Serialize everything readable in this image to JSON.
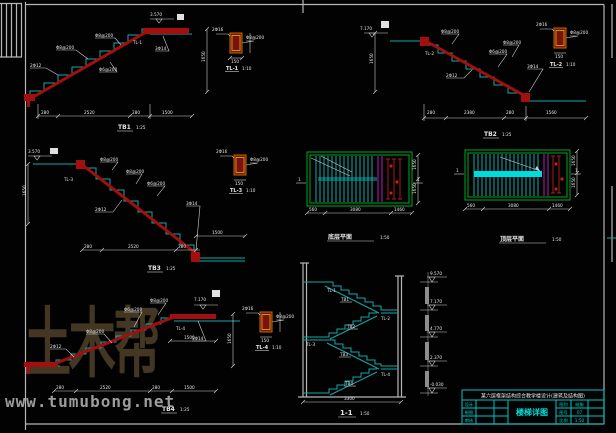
{
  "watermark": {
    "logo": "土木帮",
    "site": "www.tumubong.net"
  },
  "tb1": {
    "title": "TB1",
    "scale": "1:25",
    "level": "3.570",
    "callouts": [
      "Φ8@200",
      "2Φ12",
      "Φ8@200",
      "Φ6@200",
      "3Φ14",
      "TL-1"
    ],
    "dims": {
      "bottom": [
        "280",
        "2520",
        "280",
        "1500"
      ],
      "vertical": "1650"
    },
    "detail": {
      "name": "TL-1",
      "scale": "1:10",
      "width": "150",
      "callouts": [
        "2Φ16",
        "Φ8@200"
      ]
    }
  },
  "tb2": {
    "title": "TB2",
    "scale": "1:25",
    "level": "7.170",
    "callouts": [
      "Φ8@200",
      "Φ6@200",
      "2Φ12",
      "3Φ14",
      "TL-2",
      "Φ8@200"
    ],
    "dims": {
      "bottom": [
        "280",
        "2380",
        "280",
        "1560"
      ],
      "vertical": "1650"
    },
    "detail": {
      "name": "TL-2",
      "scale": "1:10",
      "width": "150",
      "callouts": [
        "2Φ16",
        "Φ8@200"
      ]
    }
  },
  "tb3": {
    "title": "TB3",
    "scale": "1:25",
    "level": "3.570",
    "callouts": [
      "Φ8@200",
      "Φ6@200",
      "2Φ12",
      "3Φ14",
      "TL-3",
      "Φ8@200"
    ],
    "dims": {
      "bottom": [
        "280",
        "2520",
        "280",
        "1500"
      ],
      "vertical": "1650"
    },
    "detail": {
      "name": "TL-3",
      "scale": "1:10",
      "width": "150",
      "callouts": [
        "2Φ16",
        "Φ8@200"
      ]
    }
  },
  "tb4": {
    "title": "TB4",
    "scale": "1:25",
    "level": "7.170",
    "callouts": [
      "2Φ12",
      "Φ8@200",
      "Φ6@200",
      "3Φ14",
      "TL-4",
      "Φ8@200"
    ],
    "dims": {
      "bottom": [
        "280",
        "2520",
        "280",
        "1500"
      ],
      "vertical": "1650"
    },
    "detail": {
      "name": "TL-4",
      "scale": "1:10",
      "width": "150",
      "callouts": [
        "2Φ16",
        "Φ8@200"
      ]
    }
  },
  "plan1": {
    "title": "底层平面",
    "scale": "1:50",
    "mark": "1",
    "dims": [
      "560",
      "3080",
      "1460"
    ],
    "side_dims": [
      "1650",
      "1650"
    ]
  },
  "plan2": {
    "title": "顶层平面",
    "scale": "1:50",
    "mark": "1",
    "dims": [
      "560",
      "3080",
      "1460"
    ],
    "side_dims": [
      "1650",
      "1650"
    ]
  },
  "section": {
    "title": "1-1",
    "scale": "1:50",
    "bottom_dim": "3300",
    "flights": [
      {
        "beam": "TL-1",
        "slab": "TB1"
      },
      {
        "beam": "TL-2",
        "slab": "TB2"
      },
      {
        "beam": "TL-3",
        "slab": "TB3"
      },
      {
        "beam": "TL-4",
        "slab": "TB4"
      }
    ],
    "levels": [
      "9.570",
      "7.170",
      "4.770",
      "2.370",
      "-0.030"
    ]
  },
  "titleblock": {
    "project": "某六层框架结构综合教学楼设计(建筑及结构图)",
    "left_rows": [
      "设计",
      "制图",
      "审核"
    ],
    "drawing_name": "楼梯详图",
    "pairs": [
      {
        "label": "图别",
        "value": "结施"
      },
      {
        "label": "图号",
        "value": "07"
      },
      {
        "label": "比例",
        "value": "1:50"
      }
    ]
  }
}
